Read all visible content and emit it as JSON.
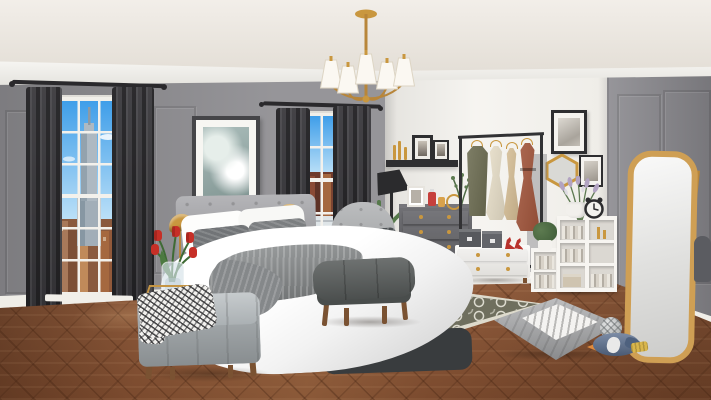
{
  "scene": {
    "domain": "game",
    "description": "3D-rendered bedroom scene from a home-design game, daytime, no HUD or text overlays",
    "room": "bedroom",
    "style": "modern glam, gray and gold",
    "visible_text": []
  },
  "counts": {
    "windows": 2,
    "chandelier_shades": 5,
    "dresser_drawers": 4,
    "rack_garments": 4,
    "tulips": 5,
    "wall_frames": 6
  },
  "palette": {
    "ceiling": "#e9e3da",
    "crown": "#f4f2ec",
    "wall_left": "#8e8d91",
    "wall_back": "#f3f1ec",
    "wall_right": "#8b8a8f",
    "baseboard": "#f0eee8",
    "floor": "#8b5434",
    "curtain": "#3a393d",
    "rod": "#2a292c",
    "window_frame": "#f1efe9",
    "sky_top": "#3f9ee9",
    "sky_bottom": "#bfe2f8",
    "empire_gray": "#aeb9c2",
    "building_brown": "#8a5a3e",
    "art_teal": "#95aca9",
    "frame_dark": "#454548",
    "frame_black": "#2e2e30",
    "gold": "#c9973f",
    "gold_deep": "#b8863a",
    "table_gold": "#c59544",
    "headboard": "#a4a4a8",
    "pillow_gray": "#717477",
    "duvet": "#ffffff",
    "throw": "#8d9091",
    "bench": "#565a59",
    "wood_leg": "#7a5232",
    "ottoman": "#a3a9ac",
    "ottoman_top": "#b4babd",
    "throw_bw_bg": "#f2f1ee",
    "tulip_red": "#c62f27",
    "stem_green": "#3f6b35",
    "chair_gray": "#abadaf",
    "chair_seat": "#9fa1a3",
    "chair_pillow": "#4b4f52",
    "lamp_black": "#2b2b2d",
    "palm_green": "#4e6b45",
    "dresser": "#5a5a5f",
    "dresser_light": "#77767b",
    "shelf_black": "#2f2f31",
    "rack": "#323234",
    "dress_olive": "#6d6d52",
    "dress_cream": "#e9e0ca",
    "dress_tan": "#d8c097",
    "dress_rust": "#a3563c",
    "unit_white": "#f6f4f0",
    "box_dark": "#57595d",
    "heel_red": "#b8322c",
    "bookshelf_white": "#f7f5f1",
    "cubby": "#dbd8d2",
    "box_beige": "#cfc4b0",
    "lavender": "#b2a3c2",
    "clock_dark": "#2c2c2e",
    "mirror_frame": "#cf9f54",
    "mirror_glass": "#e8e8e6",
    "petbed": "#a4a5a7",
    "cushion_white": "#f4f3f1",
    "ball": "#c2c5c6",
    "penguin": "#5e7292",
    "penguin_dark": "#4e617e",
    "beak_orange": "#e08a3c",
    "toy_yellow": "#d9b64b",
    "rug_olive": "#6f6f5e",
    "rug_border": "#dedbcd",
    "bottle_red": "#c6403c",
    "amber": "#d9a24b"
  },
  "objects": [
    {
      "name": "window-city-left",
      "label": "Tall window with NYC skyline and Empire State Building"
    },
    {
      "name": "window-city-right",
      "label": "Second window with city view"
    },
    {
      "name": "curtains",
      "label": "Charcoal floor-length curtains on dark rods"
    },
    {
      "name": "chandelier",
      "label": "Brass 5-arm chandelier with white shades"
    },
    {
      "name": "abstract-art",
      "label": "Framed teal abstract art between windows"
    },
    {
      "name": "bed",
      "label": "Queen bed, gray tufted headboard, white duvet, gray knit throw"
    },
    {
      "name": "gold-desk-lamps",
      "label": "Two gold dome lamps flanking headboard"
    },
    {
      "name": "side-table",
      "label": "Gold open-frame side table"
    },
    {
      "name": "tulip-vase",
      "label": "Red tulips in glass vase"
    },
    {
      "name": "accent-chair",
      "label": "Light gray tufted armchair with dark knit pillow"
    },
    {
      "name": "palm-plant",
      "label": "Potted palm beside bed"
    },
    {
      "name": "floor-lamp",
      "label": "Black task floor lamp"
    },
    {
      "name": "bed-bench",
      "label": "Dark gray bench at foot of bed"
    },
    {
      "name": "storage-ottoman",
      "label": "Gray tufted storage ottoman with herringbone throw"
    },
    {
      "name": "area-rug",
      "label": "Olive trellis-pattern rug with cream border"
    },
    {
      "name": "dresser",
      "label": "Charcoal 4-drawer dresser with gold knobs"
    },
    {
      "name": "dresser-decor",
      "label": "Photo frame, perfume bottles, gold candle holder"
    },
    {
      "name": "wall-shelf",
      "label": "Black floating shelf with photos and candles"
    },
    {
      "name": "clothing-rack",
      "label": "Black garment rack with olive, cream, tan, rust dresses"
    },
    {
      "name": "drawer-unit",
      "label": "White 2-drawer unit with storage boxes and red heels"
    },
    {
      "name": "bookshelf",
      "label": "White cubby bookshelf with books, box and candles"
    },
    {
      "name": "lavender-vase",
      "label": "Lavender sprigs in white jug"
    },
    {
      "name": "alarm-clock",
      "label": "Black retro alarm clock"
    },
    {
      "name": "hexagon-mirror",
      "label": "Gold hexagonal wall mirror"
    },
    {
      "name": "wall-frames",
      "label": "Black-framed sketches on white and gray walls"
    },
    {
      "name": "standing-mirror",
      "label": "Gold arched leaning floor mirror"
    },
    {
      "name": "pet-bed",
      "label": "Gray quilted pet bed with striped cushion"
    },
    {
      "name": "pet-toys",
      "label": "Knit ball, penguin plush, yellow brush toy"
    },
    {
      "name": "herringbone-floor",
      "label": "Warm brown herringbone wood floor"
    }
  ]
}
